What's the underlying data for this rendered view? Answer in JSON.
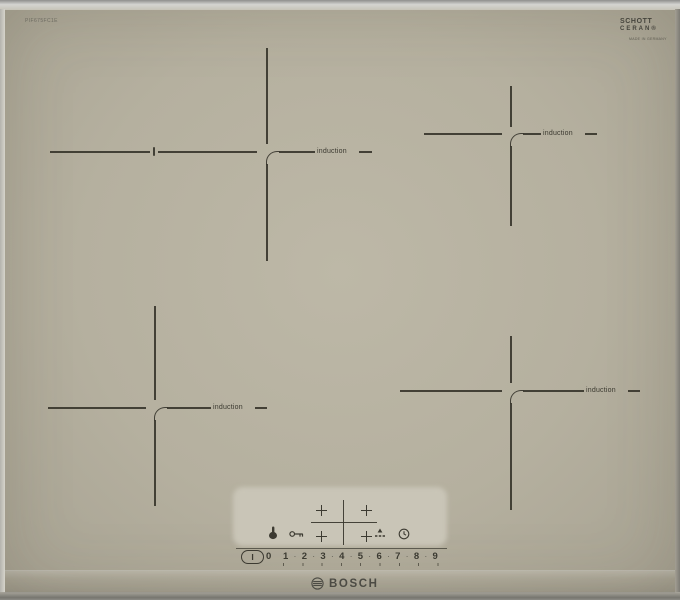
{
  "appliance": {
    "model_number": "PIF675FC1E",
    "brand": "BOSCH",
    "glass_branding": {
      "line1": "SCHOTT",
      "line2": "CERAN®",
      "sub_text": "MADE IN GERMANY"
    }
  },
  "zones": {
    "items": [
      {
        "name": "rear-left",
        "label": "induction"
      },
      {
        "name": "rear-right",
        "label": "induction"
      },
      {
        "name": "front-left",
        "label": "induction"
      },
      {
        "name": "front-right",
        "label": "induction"
      }
    ]
  },
  "control_panel": {
    "power_symbol": "I",
    "level_zero": "0",
    "levels": [
      "1",
      "2",
      "3",
      "4",
      "5",
      "6",
      "7",
      "8",
      "9"
    ],
    "separator": "·",
    "icons": {
      "cleaning_pause": "hand-touch-icon",
      "child_lock": "key-icon",
      "zone_selector": "four-zone-cross-icon",
      "timer_reset": "triangle-dash-icon",
      "kitchen_timer": "clock-icon"
    }
  },
  "colors": {
    "glass": "#b5b09f",
    "ink": "#38362d",
    "panel": "#c9c5b7"
  }
}
